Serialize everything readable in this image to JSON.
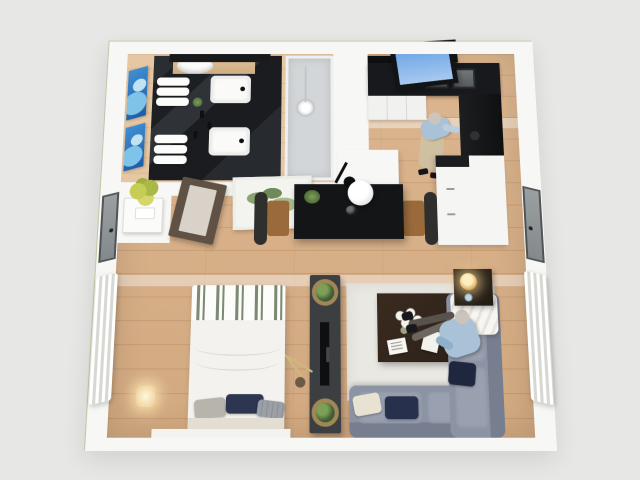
{
  "scene": {
    "type": "3d-floor-plan-render",
    "description": "Top-down 3D rendering of a studio apartment with bathroom, kitchen, dining area, bedroom and living room on light wood flooring",
    "visible_text": [],
    "people": {
      "kitchen_person": "Man in blue shirt and khaki trousers cooking at the kitchen counter",
      "living_person": "Man in blue shirt seated on the sectional sofa with his feet up by the coffee table"
    }
  },
  "colors": {
    "bg": "#e7e8e5",
    "wall": "#f7f7f5",
    "wall_edge": "#c6c4a2",
    "wood": "#dcb68f",
    "counter": "#17191c",
    "table_black": "#141517",
    "media": "#3b3f42",
    "sofa": "#8b93a4",
    "sofa_cushion": "#99a1b1",
    "rug": "#eae8e2",
    "duvet": "#f3f2ee",
    "stripe_green": "#7c8a74",
    "pillow_navy": "#2c3651",
    "pillow_gray": "#b7b4ab",
    "seat_tan": "#9a6a3b",
    "chair_back": "#2f2f2d",
    "basket": "#a08756",
    "plant_yellow": "#c6cd55",
    "shirt": "#a9c2d7",
    "khaki": "#cfc0a2",
    "sky": "#6fa6e6"
  },
  "rooms": {
    "apartment": {
      "label": "Studio apartment 3D floor plan"
    },
    "bathroom": {
      "label": "Bathroom",
      "items": {
        "vanity": "Dark stone double vanity",
        "sink": "White vessel sink",
        "bowl": "White basin bowl on wood shelf",
        "towels": "Rolled white towels",
        "mirror": "Vanity mirror",
        "shower": "Walk-in glass shower with rain head",
        "art": "Blue abstract wall art",
        "door": "Bathroom door"
      }
    },
    "kitchen": {
      "label": "Kitchen",
      "items": {
        "window": "Open window with sky view",
        "counter": "Black countertop with double sink",
        "upper": "Dark upper cabinets",
        "cabinets": "White base cabinets",
        "tall": "Black cooktop / oven unit",
        "peninsula": "White kitchen peninsula"
      }
    },
    "dining": {
      "label": "Dining area",
      "items": {
        "table": "Black dining table",
        "chair": "Dining chair with tan seat",
        "pendant": "White pendant lamp",
        "plant": "Table plant",
        "vase": "Dark vase",
        "art": "Botanical framed print",
        "counter": "White wall counter"
      }
    },
    "entry": {
      "label": "Entry",
      "items": {
        "door": "Entry door",
        "console": "Console table",
        "plant": "Yellow-green plant"
      }
    },
    "bedroom": {
      "label": "Bedroom",
      "items": {
        "bed": "Double bed with white duvet and green striped runner",
        "pillow_gray": "Gray pillow",
        "pillow_navy": "Navy pillow",
        "pillow_plaid": "Plaid pillow",
        "curtain": "Sheer white curtains",
        "lamp": "Lit wall sconce",
        "platform": "Bed platform"
      }
    },
    "living": {
      "label": "Living room",
      "items": {
        "rug": "Light area rug",
        "coffee_table": "Dark wood coffee table",
        "flowers": "White flowers",
        "book": "Open book",
        "magazine": "Magazine",
        "sofa": "L-shaped grey sectional sofa",
        "throw": "White throw blanket",
        "side_table": "Side table with lit brass lamp",
        "curtain": "Sheer white curtains",
        "door": "Closet door",
        "media": "Black media console",
        "tv": "Flat-screen TV",
        "plant": "Potted plant in woven basket"
      }
    }
  }
}
